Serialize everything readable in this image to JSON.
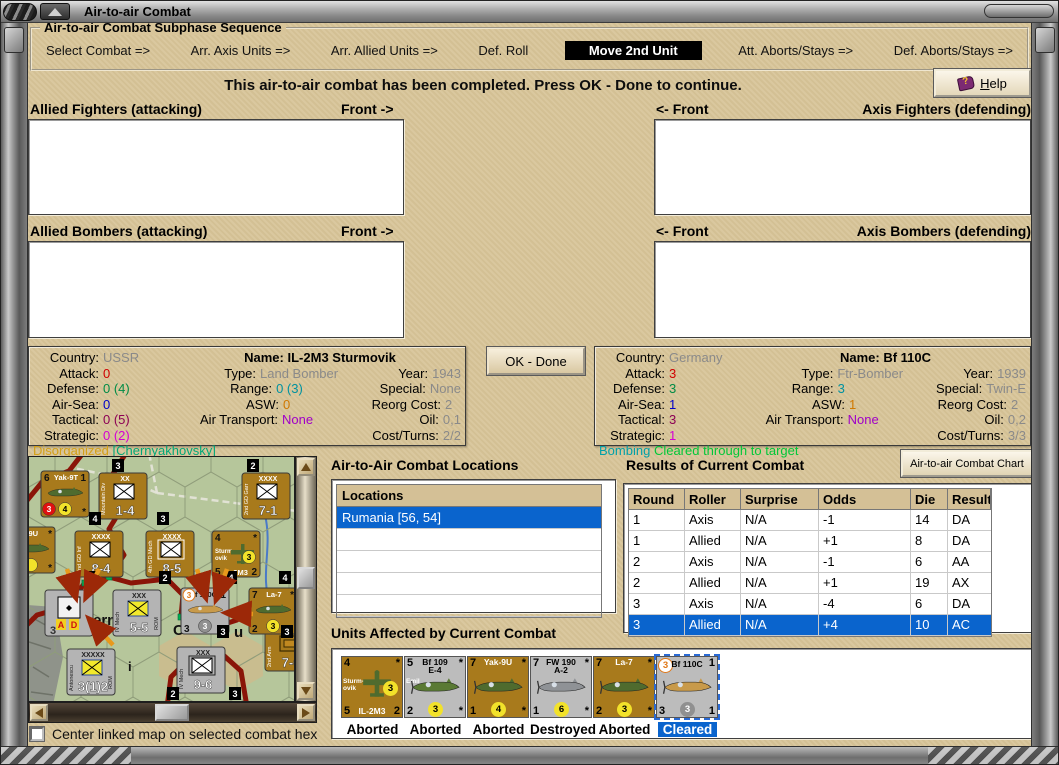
{
  "window": {
    "title": "Air-to-air Combat"
  },
  "sequence": {
    "title": "Air-to-air Combat Subphase Sequence",
    "steps": [
      {
        "label": "Select Combat =>",
        "active": false
      },
      {
        "label": "Arr. Axis Units =>",
        "active": false
      },
      {
        "label": "Arr. Allied Units =>",
        "active": false
      },
      {
        "label": "Def. Roll",
        "active": false
      },
      {
        "label": "Move 2nd Unit",
        "active": true
      },
      {
        "label": "Att. Aborts/Stays =>",
        "active": false
      },
      {
        "label": "Def. Aborts/Stays =>",
        "active": false
      }
    ]
  },
  "message": "This air-to-air combat has been completed.  Press OK - Done to continue.",
  "help": {
    "accel": "H",
    "rest": "elp"
  },
  "labels": {
    "allied_fighters": "Allied Fighters (attacking)",
    "axis_fighters": "Axis Fighters (defending)",
    "allied_bombers": "Allied Bombers (attacking)",
    "axis_bombers": "Axis Bombers (defending)",
    "front_right": "Front ->",
    "front_left": "<- Front"
  },
  "ok_done": "OK - Done",
  "stat_labels": {
    "country": "Country:",
    "name": "Name:",
    "attack": "Attack:",
    "type": "Type:",
    "year": "Year:",
    "defense": "Defense:",
    "range": "Range:",
    "special": "Special:",
    "airsea": "Air-Sea:",
    "asw": "ASW:",
    "reorg": "Reorg Cost:",
    "tactical": "Tactical:",
    "airtransport": "Air Transport:",
    "oil": "Oil:",
    "strategic": "Strategic:",
    "costturns": "Cost/Turns:"
  },
  "left_unit": {
    "country": "USSR",
    "name": "IL-2M3 Sturmovik",
    "attack": "0",
    "type": "Land Bomber",
    "year": "1943",
    "defense": "0 (4)",
    "range": "0 (3)",
    "special": "None",
    "airsea": "0",
    "asw": "0",
    "reorg": "2",
    "tactical": "0 (5)",
    "airtransport": "None",
    "oil": "0,1",
    "strategic": "0 (2)",
    "costturns": "2/2",
    "status_a": "Disorganized",
    "status_b": "[Chernyakhovsky]"
  },
  "right_unit": {
    "country": "Germany",
    "name": "Bf 110C",
    "attack": "3",
    "type": "Ftr-Bomber",
    "year": "1939",
    "defense": "3",
    "range": "3",
    "special": "Twin-E",
    "airsea": "1",
    "asw": "1",
    "reorg": "2",
    "tactical": "3",
    "airtransport": "None",
    "oil": "0,2",
    "strategic": "1",
    "costturns": "3/3",
    "status_a": "Bombing",
    "status_b": "Cleared through to target"
  },
  "locations": {
    "title": "Air-to-Air Combat Locations",
    "header": "Locations",
    "rows": [
      "Rumania [56, 54]"
    ],
    "selected_index": 0,
    "empty_rows": 4
  },
  "results": {
    "title": "Results of Current Combat",
    "chart_button": "Air-to-air Combat Chart",
    "columns": [
      "Round",
      "Roller",
      "Surprise",
      "Odds",
      "Die",
      "Result"
    ],
    "rows": [
      [
        "1",
        "Axis",
        "N/A",
        "-1",
        "14",
        "DA"
      ],
      [
        "1",
        "Allied",
        "N/A",
        "+1",
        "8",
        "DA"
      ],
      [
        "2",
        "Axis",
        "N/A",
        "-1",
        "6",
        "AA"
      ],
      [
        "2",
        "Allied",
        "N/A",
        "+1",
        "19",
        "AX PX"
      ],
      [
        "3",
        "Axis",
        "N/A",
        "-4",
        "6",
        "DA"
      ],
      [
        "3",
        "Allied",
        "N/A",
        "+4",
        "10",
        "AC"
      ]
    ],
    "selected_index": 5
  },
  "units_affected": {
    "title": "Units Affected by Current Combat",
    "units": [
      {
        "name": "IL-2M3",
        "bg": "#a87a1c",
        "name_color": "#fff",
        "tl": "4",
        "title": "",
        "title2": "",
        "tr": "*",
        "side": "Sturm-|ovik",
        "plane": "top",
        "plane_color": "#4f6b2e",
        "bl": "5",
        "circle": "3",
        "circle_bg": "#f2e22a",
        "circle_fg": "#000",
        "circle_pos": "mid",
        "br": "2",
        "bottom_name": "IL-2M3",
        "tl_circle": false,
        "status": "Aborted",
        "selected": false
      },
      {
        "name": "Bf 109 E-4",
        "bg": "#bcbcbc",
        "name_color": "#000",
        "tl": "5",
        "title": "Bf 109",
        "title2": "E-4",
        "tr": "*",
        "side": "Emil",
        "plane": "side",
        "plane_color": "#5a7a34",
        "bl": "2",
        "circle": "3",
        "circle_bg": "#f2e22a",
        "circle_fg": "#000",
        "circle_pos": "bottom",
        "br": "*",
        "bottom_name": "",
        "tl_circle": false,
        "status": "Aborted",
        "selected": false
      },
      {
        "name": "Yak-9U",
        "bg": "#a87a1c",
        "name_color": "#fff",
        "tl": "7",
        "title": "Yak-9U",
        "title2": "",
        "tr": "*",
        "side": "",
        "plane": "side",
        "plane_color": "#4f6b2e",
        "bl": "1",
        "circle": "4",
        "circle_bg": "#f2e22a",
        "circle_fg": "#000",
        "circle_pos": "bottom",
        "br": "*",
        "bottom_name": "",
        "tl_circle": false,
        "status": "Aborted",
        "selected": false
      },
      {
        "name": "FW 190 A-2",
        "bg": "#bcbcbc",
        "name_color": "#000",
        "tl": "7",
        "title": "FW 190",
        "title2": "A-2",
        "tr": "*",
        "side": "",
        "plane": "side",
        "plane_color": "#8f9296",
        "bl": "1",
        "circle": "6",
        "circle_bg": "#f2e22a",
        "circle_fg": "#000",
        "circle_pos": "bottom",
        "br": "*",
        "bottom_name": "",
        "tl_circle": false,
        "status": "Destroyed",
        "selected": false
      },
      {
        "name": "La-7",
        "bg": "#a87a1c",
        "name_color": "#fff",
        "tl": "7",
        "title": "La-7",
        "title2": "",
        "tr": "*",
        "side": "",
        "plane": "side",
        "plane_color": "#4f6b2e",
        "bl": "2",
        "circle": "3",
        "circle_bg": "#f2e22a",
        "circle_fg": "#000",
        "circle_pos": "bottom",
        "br": "*",
        "bottom_name": "",
        "tl_circle": false,
        "status": "Aborted",
        "selected": false
      },
      {
        "name": "Bf 110C",
        "bg": "#bcbcbc",
        "name_color": "#000",
        "tl": "3",
        "title": "Bf 110C",
        "title2": "",
        "tr": "1",
        "side": "",
        "plane": "side",
        "plane_color": "#c89a4a",
        "bl": "3",
        "circle": "3",
        "circle_bg": "#909090",
        "circle_fg": "#fff",
        "circle_pos": "bottom",
        "br": "1",
        "bottom_name": "",
        "tl_circle": true,
        "status": "Cleared",
        "selected": true
      }
    ]
  },
  "map": {
    "checkbox_label": "Center linked map on selected combat hex",
    "terrain_color": "#b6c69b",
    "front_color": "#8a1508",
    "front_paths": [
      "M54,-4 L40,14 L14,24 L-4,46",
      "M97,-4 L82,20 L96,46 L80,72 L95,98 L80,120 L56,126 L36,150 L8,158 L-4,170",
      "M80,120 L102,126 L138,122 L154,138 L152,160 L180,172 L208,163 L226,140 L252,133 L271,142",
      "M138,250 L142,220 L162,200 L192,196 L212,214 L218,250"
    ],
    "roads": [
      "M128,36 L268,54",
      "M128,36 L96,22 L40,10",
      "M128,36 L120,-4"
    ],
    "rivers": [
      "M236,58 C244,92 230,118 242,150 C248,166 240,180 246,202"
    ],
    "tan_hexes": [
      [
        156,
        204
      ],
      [
        208,
        204
      ]
    ],
    "green_dots": [
      [
        80,
        120
      ],
      [
        56,
        126
      ],
      [
        152,
        160
      ]
    ],
    "labels": [
      {
        "x": 64,
        "y": 168,
        "t": "ern",
        "s": 15
      },
      {
        "x": 144,
        "y": 178,
        "t": "C",
        "s": 15
      },
      {
        "x": 205,
        "y": 180,
        "t": "u",
        "s": 15
      },
      {
        "x": 99,
        "y": 214,
        "t": "i",
        "s": 13
      }
    ],
    "ground_counters": [
      {
        "x": 70,
        "y": 16,
        "bg": "#a87a1c",
        "top": "XX",
        "sym": "wx",
        "num": "1-4",
        "side": "Mountain Div",
        "rside": ""
      },
      {
        "x": 213,
        "y": 16,
        "bg": "#a87a1c",
        "top": "XXXX",
        "sym": "wx",
        "num": "7-1",
        "side": "2nd GD Garr",
        "rside": ""
      },
      {
        "x": 46,
        "y": 74,
        "bg": "#a87a1c",
        "top": "XXXX",
        "sym": "wx",
        "num": "8-4",
        "side": "2nd GD Inf",
        "rside": ""
      },
      {
        "x": 117,
        "y": 74,
        "bg": "#a87a1c",
        "top": "XXXX",
        "sym": "fx",
        "num": "8-5",
        "side": "4th GD Mech",
        "rside": ""
      },
      {
        "x": 84,
        "y": 133,
        "bg": "#b4b4b4",
        "top": "XXX",
        "sym": "yx",
        "num": "5-5",
        "side": "IV Mech",
        "rside": "ROM"
      },
      {
        "x": 38,
        "y": 192,
        "bg": "#b4b4b4",
        "top": "XXXXX",
        "sym": "yx",
        "num": "3(1)2",
        "side": "Antonescu",
        "rside": "ROM"
      },
      {
        "x": 148,
        "y": 190,
        "bg": "#b4b4b4",
        "top": "XXX",
        "sym": "fx",
        "num": "9-6",
        "side": "IV Mech",
        "rside": ""
      },
      {
        "x": 236,
        "y": 168,
        "bg": "#a87a1c",
        "top": "XXXX",
        "sym": "ob",
        "num": "7-6",
        "side": "2nd Arm",
        "rside": ""
      }
    ],
    "marker": {
      "x": 16,
      "y": 133,
      "a": "A",
      "d": "D",
      "num": "3"
    },
    "air_counters": [
      {
        "x": 12,
        "y": 14,
        "bg": "#a87a1c",
        "tl": "6",
        "name": "Yak-9T",
        "tr": "1",
        "pc": "#4f6b2e",
        "plane": "side",
        "blc": {
          "v": "3",
          "bg": "#e01010",
          "fg": "#fff"
        },
        "bcc": {
          "v": "4",
          "bg": "#f2e22a",
          "fg": "#000"
        },
        "bl": "",
        "br": "*",
        "bname": ""
      },
      {
        "x": -22,
        "y": 70,
        "bg": "#a87a1c",
        "tl": "",
        "name": "-9U",
        "tr": "*",
        "pc": "#4f6b2e",
        "plane": "side",
        "blc": null,
        "bcc": {
          "v": "",
          "bg": "#f2e22a",
          "fg": "#000"
        },
        "bl": "",
        "br": "*",
        "bname": ""
      },
      {
        "x": 183,
        "y": 74,
        "bg": "#a87a1c",
        "tl": "4",
        "name": "",
        "tr": "*",
        "pc": "#4f6b2e",
        "plane": "top",
        "blc": null,
        "bcc": {
          "v": "3",
          "bg": "#f2e22a",
          "fg": "#000"
        },
        "bl": "5",
        "br": "2",
        "bname": "IL-2M3",
        "side": "Sturm-|ovik"
      },
      {
        "x": 152,
        "y": 131,
        "bg": "#b4b4b4",
        "tl": "3",
        "tlc": true,
        "name": "f 110C",
        "tr": "1",
        "pc": "#c89a4a",
        "plane": "side",
        "blc": null,
        "bcc": {
          "v": "3",
          "bg": "#909090",
          "fg": "#fff"
        },
        "bl": "3",
        "br": "1",
        "bname": ""
      },
      {
        "x": 220,
        "y": 131,
        "bg": "#a87a1c",
        "tl": "7",
        "name": "La-7",
        "tr": "*",
        "pc": "#4f6b2e",
        "plane": "side",
        "blc": null,
        "bcc": {
          "v": "3",
          "bg": "#f2e22a",
          "fg": "#000"
        },
        "bl": "2",
        "br": "",
        "bname": ""
      }
    ],
    "badges": [
      [
        83,
        2,
        "3"
      ],
      [
        218,
        2,
        "2"
      ],
      [
        60,
        55,
        "4"
      ],
      [
        128,
        55,
        "3"
      ],
      [
        58,
        114,
        "5"
      ],
      [
        130,
        114,
        "2"
      ],
      [
        196,
        114,
        "4"
      ],
      [
        250,
        114,
        "4"
      ],
      [
        188,
        168,
        "3"
      ],
      [
        252,
        168,
        "3"
      ],
      [
        138,
        230,
        "2"
      ],
      [
        200,
        230,
        "3"
      ]
    ],
    "arrows": [
      [
        38,
        112,
        46,
        138
      ],
      [
        70,
        112,
        58,
        138
      ],
      [
        84,
        188,
        62,
        164
      ],
      [
        168,
        112,
        176,
        138
      ],
      [
        198,
        112,
        188,
        140
      ],
      [
        224,
        157,
        200,
        156
      ]
    ]
  }
}
